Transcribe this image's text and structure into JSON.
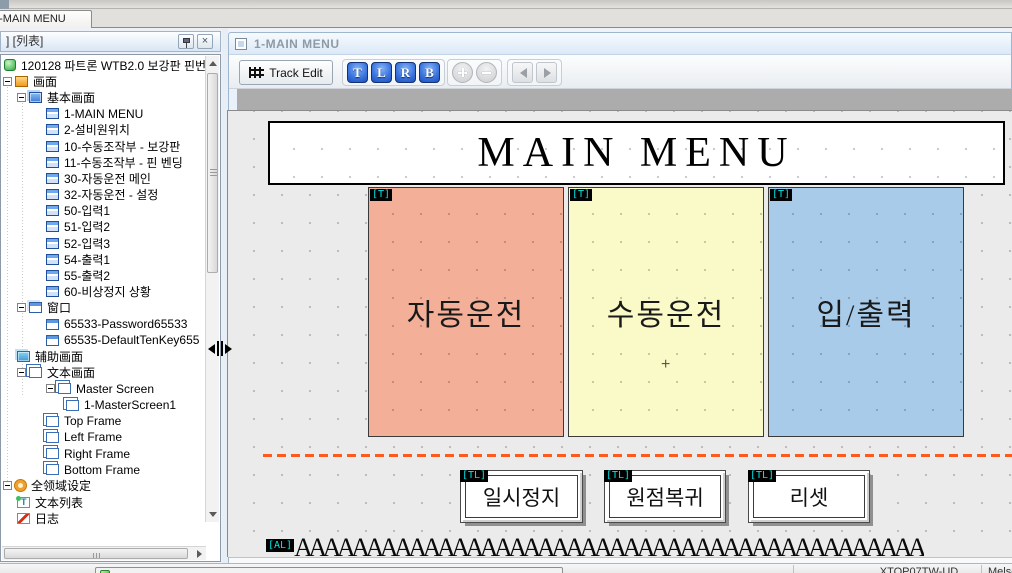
{
  "window": {
    "tab_title": "1-MAIN MENU"
  },
  "left_panel": {
    "header_label": "] [列表]",
    "tree": [
      {
        "label": "120128 파트론 WTB2.0 보강판 핀번",
        "level": 0,
        "expander": false,
        "icon": "project"
      },
      {
        "label": "画面",
        "level": 1,
        "expander": true,
        "icon": "monitor"
      },
      {
        "label": "基本画面",
        "level": 2,
        "expander": true,
        "icon": "screens"
      },
      {
        "label": "1-MAIN MENU",
        "level": 3,
        "expander": false,
        "icon": "screen"
      },
      {
        "label": "2-설비원위치",
        "level": 3,
        "expander": false,
        "icon": "screen"
      },
      {
        "label": "10-수동조작부 - 보강판",
        "level": 3,
        "expander": false,
        "icon": "screen"
      },
      {
        "label": "11-수동조작부 - 핀 벤딩",
        "level": 3,
        "expander": false,
        "icon": "screen"
      },
      {
        "label": "30-자동운전 메인",
        "level": 3,
        "expander": false,
        "icon": "screen"
      },
      {
        "label": "32-자동운전 - 설정",
        "level": 3,
        "expander": false,
        "icon": "screen"
      },
      {
        "label": "50-입력1",
        "level": 3,
        "expander": false,
        "icon": "screen"
      },
      {
        "label": "51-입력2",
        "level": 3,
        "expander": false,
        "icon": "screen"
      },
      {
        "label": "52-입력3",
        "level": 3,
        "expander": false,
        "icon": "screen"
      },
      {
        "label": "54-출력1",
        "level": 3,
        "expander": false,
        "icon": "screen"
      },
      {
        "label": "55-출력2",
        "level": 3,
        "expander": false,
        "icon": "screen"
      },
      {
        "label": "60-비상정지 상황",
        "level": 3,
        "expander": false,
        "icon": "screen"
      },
      {
        "label": "窗口",
        "level": 2,
        "expander": true,
        "icon": "windows"
      },
      {
        "label": "65533-Password65533",
        "level": 3,
        "expander": false,
        "icon": "window"
      },
      {
        "label": "65535-DefaultTenKey655",
        "level": 3,
        "expander": false,
        "icon": "window"
      },
      {
        "label": "辅助画面",
        "level": 2,
        "expander": false,
        "icon": "aux"
      },
      {
        "label": "文本画面",
        "level": 2,
        "expander": true,
        "icon": "textscreen"
      },
      {
        "label": "Master Screen",
        "level": 3,
        "expander": true,
        "icon": "frame"
      },
      {
        "label": "1-MasterScreen1",
        "level": 4,
        "expander": false,
        "icon": "frame"
      },
      {
        "label": "Top Frame",
        "level": 3,
        "expander": false,
        "icon": "frame"
      },
      {
        "label": "Left Frame",
        "level": 3,
        "expander": false,
        "icon": "frame"
      },
      {
        "label": "Right Frame",
        "level": 3,
        "expander": false,
        "icon": "frame"
      },
      {
        "label": "Bottom Frame",
        "level": 3,
        "expander": false,
        "icon": "frame"
      },
      {
        "label": "全领域设定",
        "level": 1,
        "expander": true,
        "icon": "gear"
      },
      {
        "label": "文本列表",
        "level": 2,
        "expander": false,
        "icon": "textlist"
      },
      {
        "label": "日志",
        "level": 2,
        "expander": false,
        "icon": "log"
      }
    ],
    "tabs": [
      {
        "label": "工程"
      },
      {
        "label": "列表"
      }
    ]
  },
  "editor": {
    "title": "1-MAIN MENU",
    "toolbar": {
      "track_edit_label": "Track Edit",
      "align_buttons": [
        "T",
        "L",
        "R",
        "B"
      ]
    },
    "canvas": {
      "screen_title": "MAIN MENU",
      "menu_tiles": [
        {
          "tag": "[T]",
          "label": "자동운전",
          "color": "#F3AF97"
        },
        {
          "tag": "[T]",
          "label": "수동운전",
          "color": "#FAFAC8",
          "marker": "+"
        },
        {
          "tag": "[T]",
          "label": "입/출력",
          "color": "#A9CBEA"
        }
      ],
      "action_buttons": [
        {
          "tag": "[TL]",
          "label": "일시정지"
        },
        {
          "tag": "[TL]",
          "label": "원점복귀"
        },
        {
          "tag": "[TL]",
          "label": "리셋"
        }
      ],
      "alarm_row": {
        "tag": "[AL]",
        "text": "AAAAAAAAAAAAAAAAAAAAAAAAAAAAAAAAAAAAAAAAAAAAAA"
      }
    }
  },
  "status_bar": {
    "device": "XTOP07TW-UD",
    "plc": "Melsec FX"
  }
}
